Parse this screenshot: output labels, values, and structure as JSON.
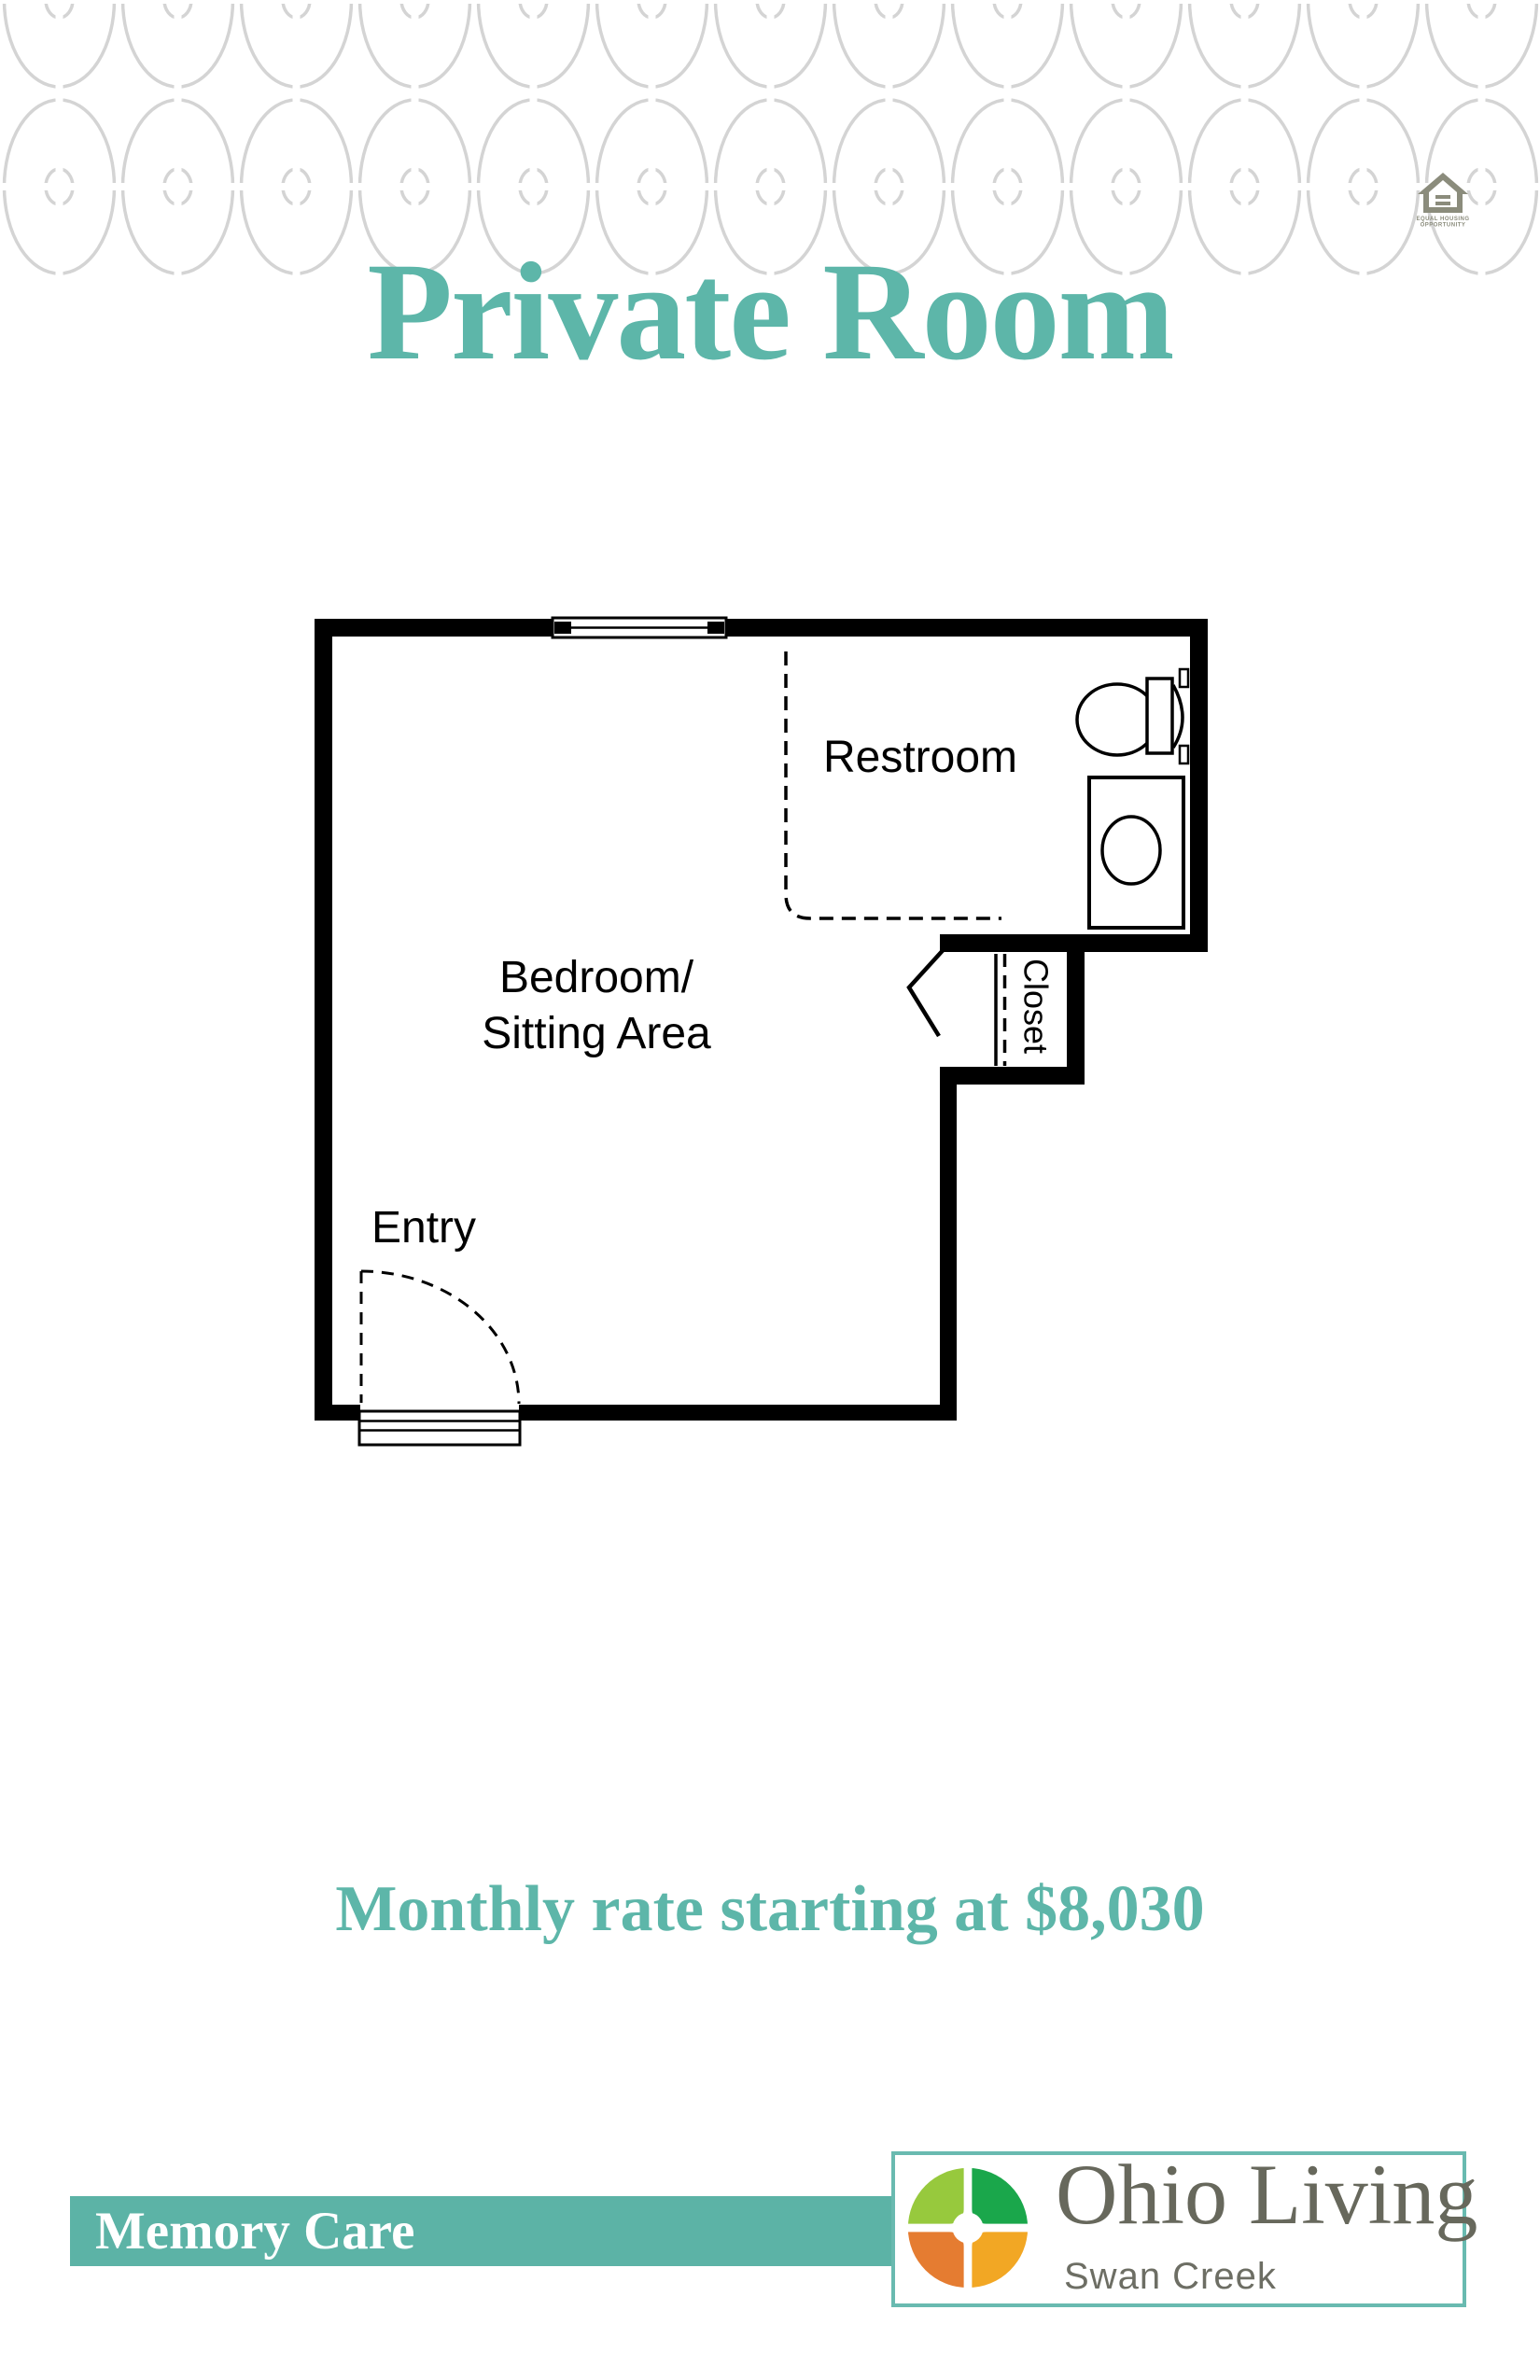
{
  "document": {
    "title": "Private Room",
    "pricing_text": "Monthly rate starting at $8,030"
  },
  "floor_plan": {
    "room_labels": {
      "restroom": "Restroom",
      "bedroom_line1": "Bedroom/",
      "bedroom_line2": "Sitting Area",
      "entry": "Entry",
      "closet": "Closet"
    }
  },
  "equal_housing": {
    "line1": "EQUAL HOUSING",
    "line2": "OPPORTUNITY"
  },
  "footer": {
    "care_level": "Memory Care",
    "brand_name": "Ohio Living",
    "brand_location": "Swan Creek"
  },
  "colors": {
    "accent_teal": "#5db6a9",
    "care_bar_teal": "#5cb3a6",
    "brand_border_teal": "#69bab0",
    "brand_text_gray": "#67685c",
    "logo_quadrant_top_left": "#97c93d",
    "logo_quadrant_top_right": "#1aa74b",
    "logo_quadrant_bottom_left": "#e57c31",
    "logo_quadrant_bottom_right": "#f2a724",
    "equal_housing_olive": "#8b8c7c",
    "pattern_gray": "#d4d4d4",
    "plan_line_black": "#000000"
  }
}
